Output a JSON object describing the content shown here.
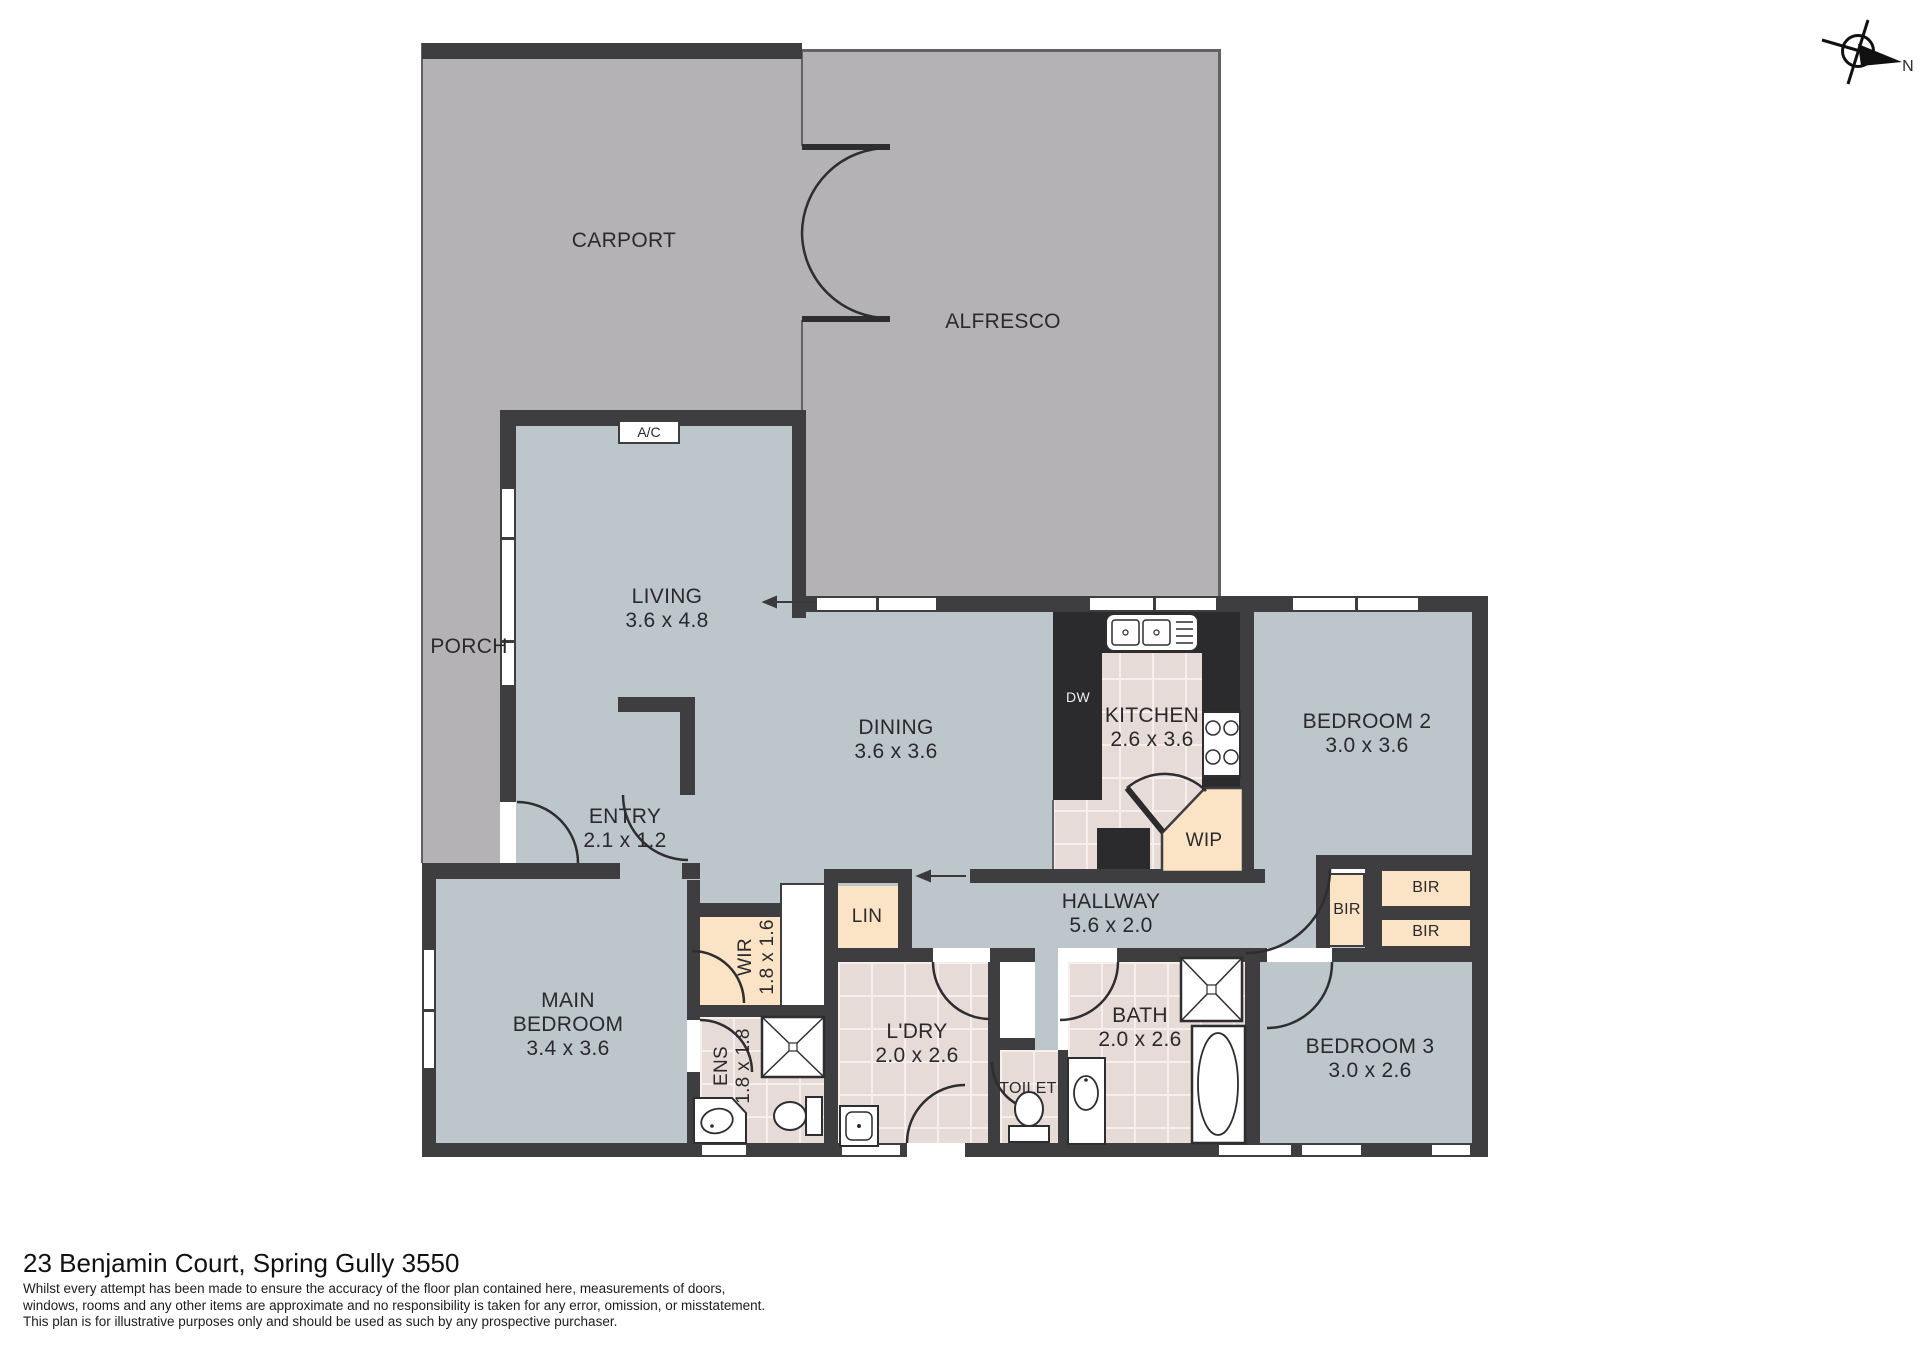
{
  "colors": {
    "wall": "#3e3d40",
    "outdoor_area": "#b4b2b4",
    "interior_floor": "#bdc6ca",
    "wet_area_tile": "#e7dbd7",
    "closet_fill": "#fbe3c6",
    "kitchen_counter": "#2b2b2d",
    "fixture_fill": "#ffffff"
  },
  "compass": {
    "north_label": "N"
  },
  "rooms": {
    "carport": {
      "lines": [
        "CARPORT"
      ]
    },
    "alfresco": {
      "lines": [
        "ALFRESCO"
      ]
    },
    "porch": {
      "lines": [
        "PORCH"
      ]
    },
    "living": {
      "lines": [
        "LIVING",
        "3.6 x 4.8"
      ]
    },
    "dining": {
      "lines": [
        "DINING",
        "3.6 x 3.6"
      ]
    },
    "kitchen": {
      "lines": [
        "KITCHEN",
        "2.6 x 3.6"
      ]
    },
    "bedroom2": {
      "lines": [
        "BEDROOM 2",
        "3.0 x 3.6"
      ]
    },
    "entry": {
      "lines": [
        "ENTRY",
        "2.1 x 1.2"
      ]
    },
    "wip": {
      "lines": [
        "WIP"
      ]
    },
    "hallway": {
      "lines": [
        "HALLWAY",
        "5.6 x 2.0"
      ]
    },
    "lin": {
      "lines": [
        "LIN"
      ]
    },
    "wir": {
      "lines": [
        "WIR",
        "1.8 x 1.6"
      ]
    },
    "main_bedroom": {
      "lines": [
        "MAIN",
        "BEDROOM",
        "3.4 x 3.6"
      ]
    },
    "ens": {
      "lines": [
        "ENS",
        "1.8 x 1.8"
      ]
    },
    "ldry": {
      "lines": [
        "L'DRY",
        "2.0 x 2.6"
      ]
    },
    "toilet": {
      "lines": [
        "TOILET"
      ]
    },
    "bath": {
      "lines": [
        "BATH",
        "2.0 x 2.6"
      ]
    },
    "bedroom3": {
      "lines": [
        "BEDROOM 3",
        "3.0 x 2.6"
      ]
    },
    "bir_hall": {
      "lines": [
        "BIR"
      ]
    },
    "bir_top": {
      "lines": [
        "BIR"
      ]
    },
    "bir_bottom": {
      "lines": [
        "BIR"
      ]
    }
  },
  "equipment": {
    "ac": "A/C",
    "dw": "DW"
  },
  "fixture_icons": [
    "double-sink-icon",
    "cooktop-icon",
    "shower-icon",
    "bathtub-icon",
    "vanity-basin-icon",
    "toilet-icon",
    "laundry-trough-icon",
    "door-swing-arc",
    "compass-rose-icon"
  ],
  "footer": {
    "address": "23 Benjamin Court, Spring Gully 3550",
    "disclaimer_lines": [
      "Whilst every attempt has been made to ensure the accuracy of the floor plan contained here, measurements of doors,",
      "windows, rooms and any other items are approximate and no responsibility is taken for any error, omission, or misstatement.",
      "This plan is for illustrative purposes only and should be used as such by any prospective purchaser."
    ]
  }
}
